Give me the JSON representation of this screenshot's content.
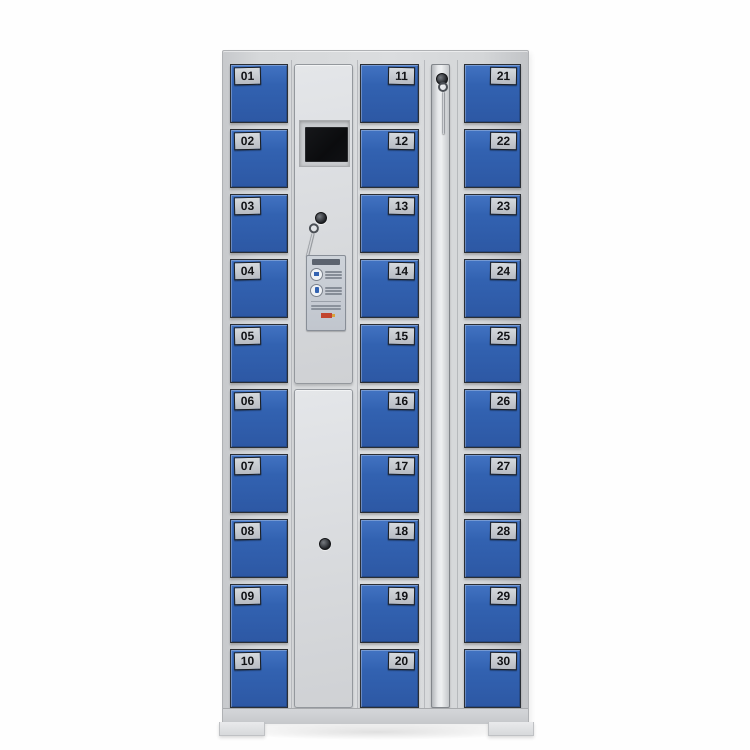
{
  "meta": {
    "subject": "30-compartment electronic storage locker cabinet, product photo on white background",
    "compartment_count": 30
  },
  "colors": {
    "door_blue": "#3262b1",
    "body_gray": "#d6d8da",
    "number_label_bg": "#c4c8ce",
    "screen_black": "#0c0d0f",
    "stamp_red": "#c2452f",
    "background": "#ffffff"
  },
  "doors": {
    "left": [
      "01",
      "02",
      "03",
      "04",
      "05",
      "06",
      "07",
      "08",
      "09",
      "10"
    ],
    "middle": [
      "11",
      "12",
      "13",
      "14",
      "15",
      "16",
      "17",
      "18",
      "19",
      "20"
    ],
    "right": [
      "21",
      "22",
      "23",
      "24",
      "25",
      "26",
      "27",
      "28",
      "29",
      "30"
    ]
  },
  "control_panel": {
    "screen": "blank dark display",
    "instruction_label": "usage instruction sticker (text illegible)",
    "icons": [
      "keyhole-lock",
      "hanging-key",
      "card",
      "phone",
      "red-stamp"
    ]
  }
}
